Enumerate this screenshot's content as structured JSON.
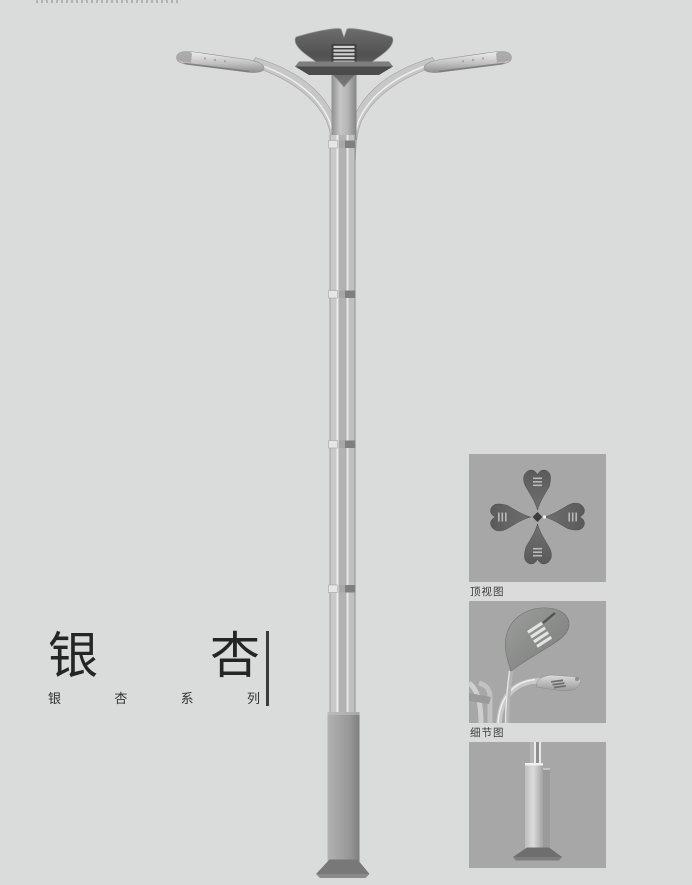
{
  "page": {
    "background_color": "#dadbdb",
    "kind": "street-lamp product catalog page"
  },
  "title_block": {
    "title": "银杏",
    "title_chars": [
      "银",
      "杏"
    ],
    "subtitle": "银杏系列",
    "subtitle_chars": [
      "银",
      "杏",
      "系",
      "列"
    ],
    "title_color": "#252525",
    "divider_color": "#3a3a3a"
  },
  "detail_views": {
    "top_view_label": "顶视图",
    "detail_view_label": "细节图",
    "panel_background": "#a6a7a6",
    "label_color": "#3c3c3c"
  },
  "illustration": {
    "subject": "ginkgo-leaf double-arm street lamp",
    "colors": {
      "crown_dark": "#515151",
      "arm_metal": "#c7c7c7",
      "pole_center": "#b2b2b2",
      "pole_highlight": "#ececec",
      "base_column": "#989898",
      "base_plate": "#787878"
    }
  }
}
